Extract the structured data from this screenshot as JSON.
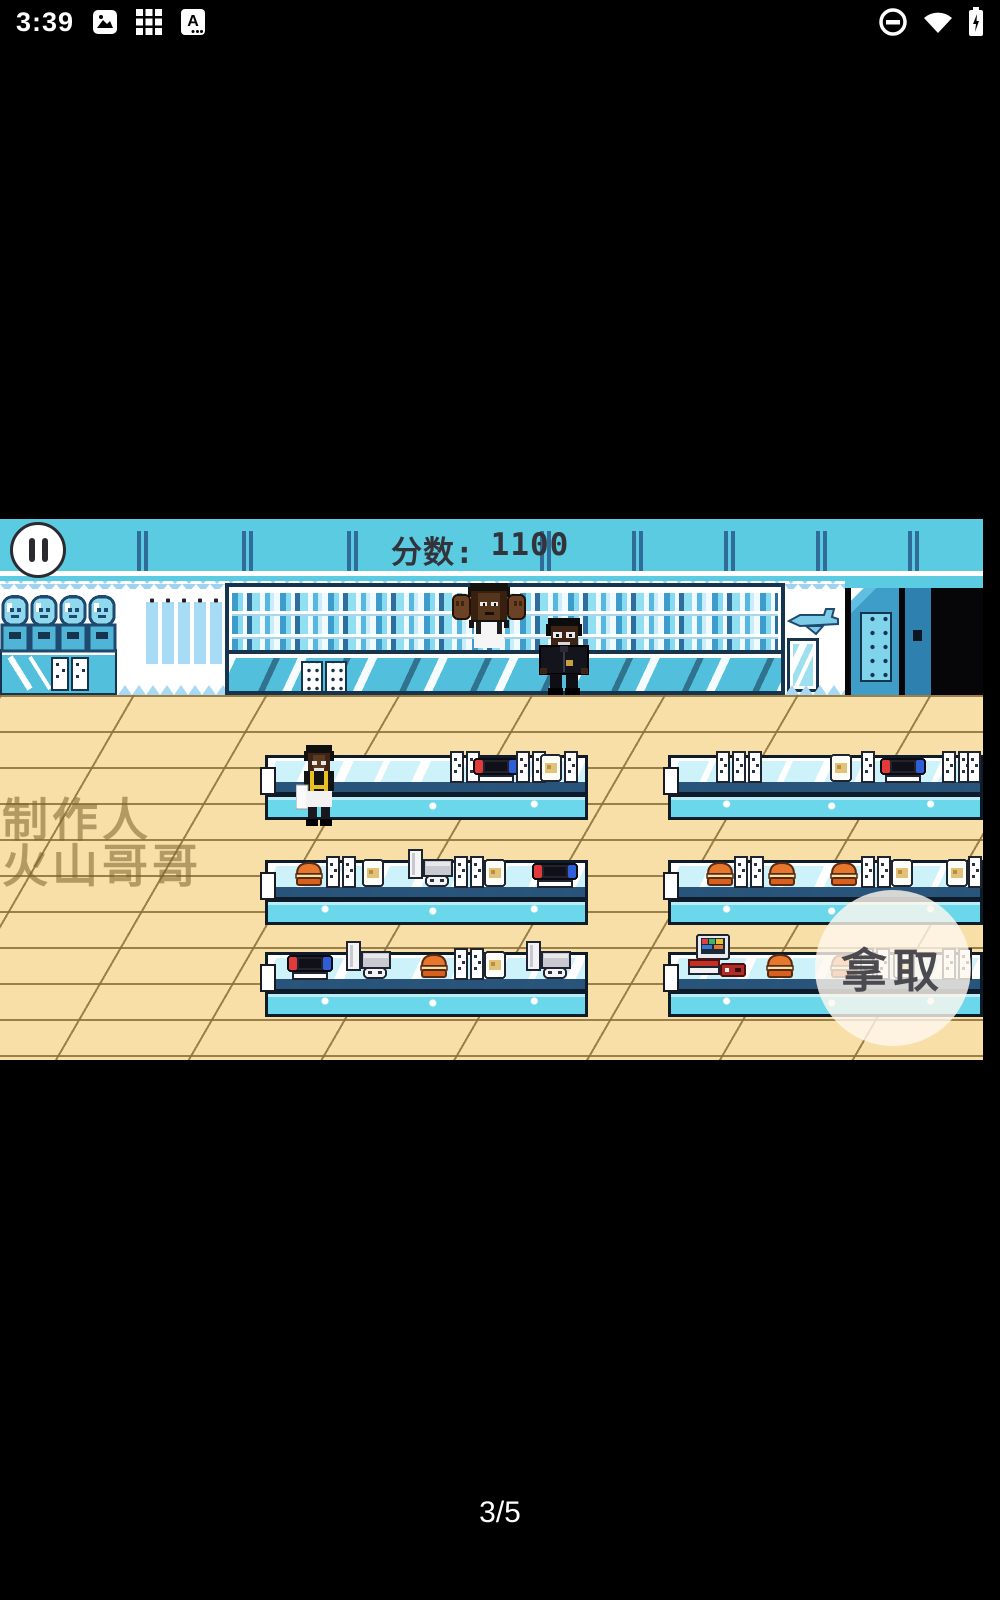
{
  "status_bar": {
    "time": "3:39",
    "left_icons": [
      "gallery-icon",
      "apps-grid-icon",
      "letter-a-icon"
    ],
    "right_icons": [
      "do-not-disturb-icon",
      "wifi-icon",
      "battery-charging-icon"
    ]
  },
  "game": {
    "hud": {
      "score_label": "分数:",
      "score_value": "1100",
      "tick_xs": [
        142,
        247,
        352,
        545,
        637,
        729,
        821,
        913
      ]
    },
    "watermark": {
      "line1": "制作人",
      "line2": "火山哥哥"
    },
    "take_button_label": "拿取",
    "scene": {
      "characters": [
        {
          "id": "shopkeeper",
          "desc": "shopkeeper with raised fists behind wall counter",
          "x": 452,
          "y": 64,
          "z": 2
        },
        {
          "id": "customer",
          "desc": "customer in dark jacket",
          "x": 536,
          "y": 99,
          "z": 4
        },
        {
          "id": "clerk",
          "desc": "clerk with yellow suspenders and apron",
          "x": 296,
          "y": 226,
          "z": 12
        }
      ],
      "tables": [
        {
          "id": "row1-left",
          "x": 265,
          "y": 236,
          "w": 323,
          "items": [
            {
              "t": "stands2",
              "x": 182
            },
            {
              "t": "switch",
              "x": 205
            },
            {
              "t": "stands2",
              "x": 248
            },
            {
              "t": "cream",
              "x": 271
            },
            {
              "t": "stand",
              "x": 296
            }
          ]
        },
        {
          "id": "row1-right",
          "x": 668,
          "y": 236,
          "w": 315,
          "items": [
            {
              "t": "stands3",
              "x": 45
            },
            {
              "t": "cream",
              "x": 158
            },
            {
              "t": "stand",
              "x": 190
            },
            {
              "t": "switch",
              "x": 209
            },
            {
              "t": "stands2",
              "x": 271
            },
            {
              "t": "stand",
              "x": 296
            }
          ]
        },
        {
          "id": "row2-left",
          "x": 265,
          "y": 341,
          "w": 323,
          "items": [
            {
              "t": "burger",
              "x": 25
            },
            {
              "t": "stands2",
              "x": 58
            },
            {
              "t": "cream",
              "x": 93
            },
            {
              "t": "ps5",
              "x": 138
            },
            {
              "t": "stands2",
              "x": 186
            },
            {
              "t": "cream",
              "x": 215
            },
            {
              "t": "switch",
              "x": 264
            }
          ]
        },
        {
          "id": "row2-right",
          "x": 668,
          "y": 341,
          "w": 315,
          "items": [
            {
              "t": "burger",
              "x": 33
            },
            {
              "t": "stands2",
              "x": 63
            },
            {
              "t": "burger",
              "x": 95
            },
            {
              "t": "burger",
              "x": 157
            },
            {
              "t": "stands2",
              "x": 190
            },
            {
              "t": "cream",
              "x": 219
            },
            {
              "t": "cream",
              "x": 274
            },
            {
              "t": "stand",
              "x": 297
            }
          ]
        },
        {
          "id": "row3-left",
          "x": 265,
          "y": 433,
          "w": 323,
          "items": [
            {
              "t": "switch",
              "x": 19
            },
            {
              "t": "ps5",
              "x": 76
            },
            {
              "t": "burger",
              "x": 150
            },
            {
              "t": "stands2",
              "x": 186
            },
            {
              "t": "cream",
              "x": 215
            },
            {
              "t": "ps5",
              "x": 256
            }
          ]
        },
        {
          "id": "row3-right",
          "x": 668,
          "y": 433,
          "w": 315,
          "items": [
            {
              "t": "retro",
              "x": 16
            },
            {
              "t": "burger",
              "x": 93
            },
            {
              "t": "burger",
              "x": 157
            },
            {
              "t": "stands2",
              "x": 189
            },
            {
              "t": "cream",
              "x": 221
            },
            {
              "t": "stands2",
              "x": 271
            }
          ]
        }
      ]
    }
  },
  "page_indicator": "3/5",
  "colors": {
    "hud_cyan": "#5BCBE1",
    "outline_navy": "#16344E",
    "furniture_cyan": "#52C0DC",
    "floor_tan": "#F8DFA8",
    "burger_orange": "#E8772E",
    "switch_red": "#E03A3A",
    "switch_blue": "#2F5FD8",
    "take_button_bg": "rgba(255,248,238,0.8)"
  }
}
